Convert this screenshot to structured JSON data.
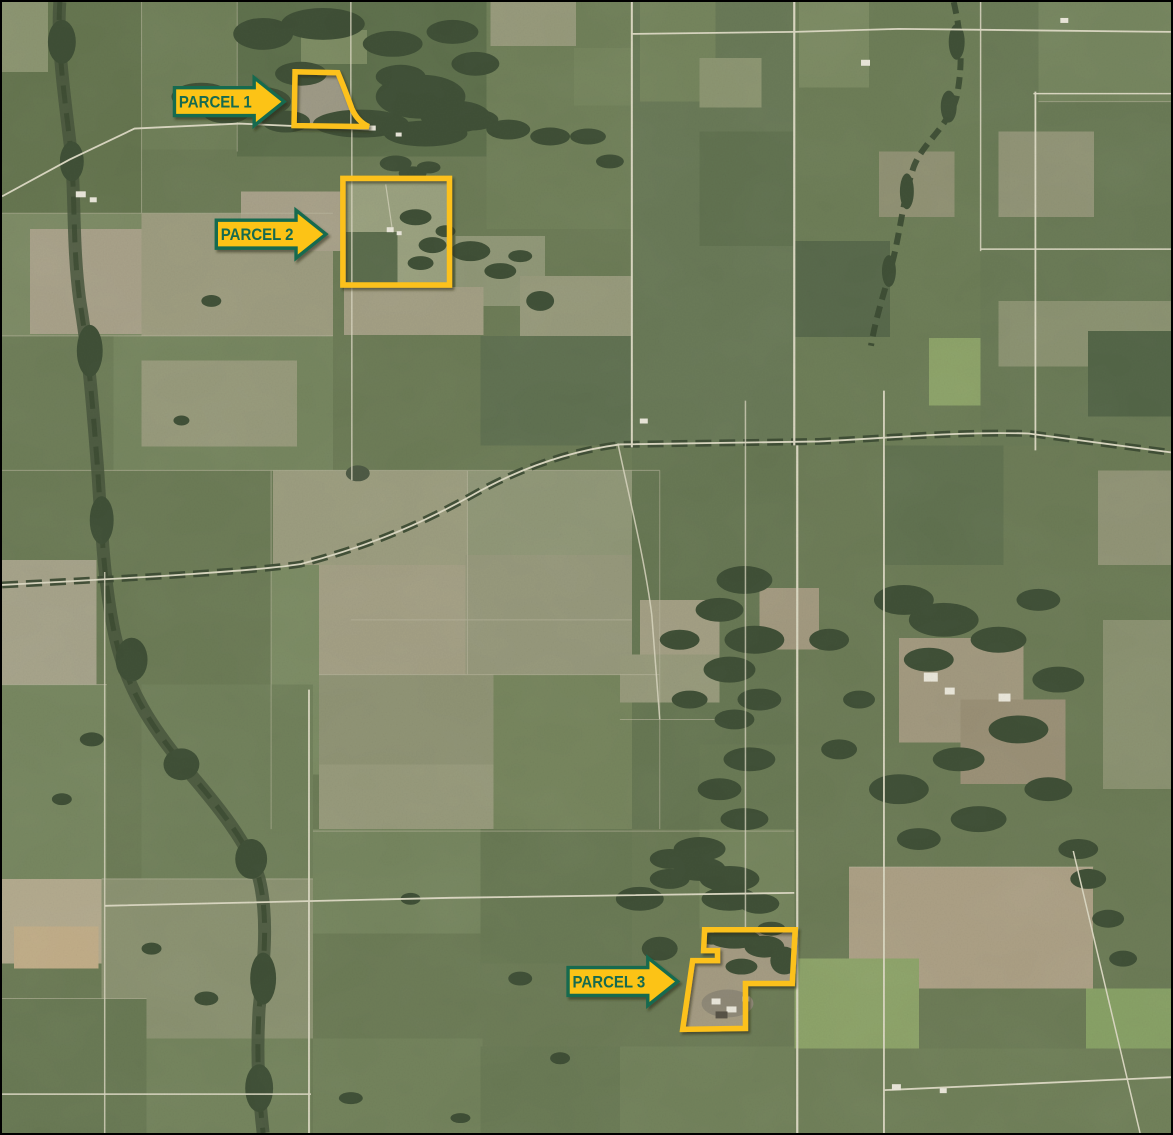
{
  "map": {
    "kind": "aerial-parcel-map",
    "parcels": [
      {
        "label": "PARCEL 1",
        "outline_path": "M294,70 L337,71 C343,85 347,96 351,107 C355,116 361,122 368,125 L293,124 Z",
        "arrow_points": "173,86 253,86 253,76 283,100 253,124 253,114 173,114",
        "label_x": 214,
        "label_y": 106
      },
      {
        "label": "PARCEL 2",
        "outline_path": "M342,177 H449 V284 H342 Z",
        "arrow_points": "215,219 295,219 295,209 325,233 295,257 295,247 215,247",
        "label_x": 256,
        "label_y": 239
      },
      {
        "label": "PARCEL 3",
        "outline_path": "M705,931 L796,931 L795,947 L793,985 L746,985 L746,1030 L683,1031 L693,962 L718,962 L718,952 L704,952 Z",
        "arrow_points": "568,969 648,969 648,959 678,983 648,1007 648,997 568,997",
        "label_x": 609,
        "label_y": 989
      }
    ],
    "colors": {
      "parcel_outline": "#FCC11A",
      "arrow_fill": "#FCC314",
      "arrow_border": "#156A50",
      "label_text": "#156A50"
    }
  }
}
